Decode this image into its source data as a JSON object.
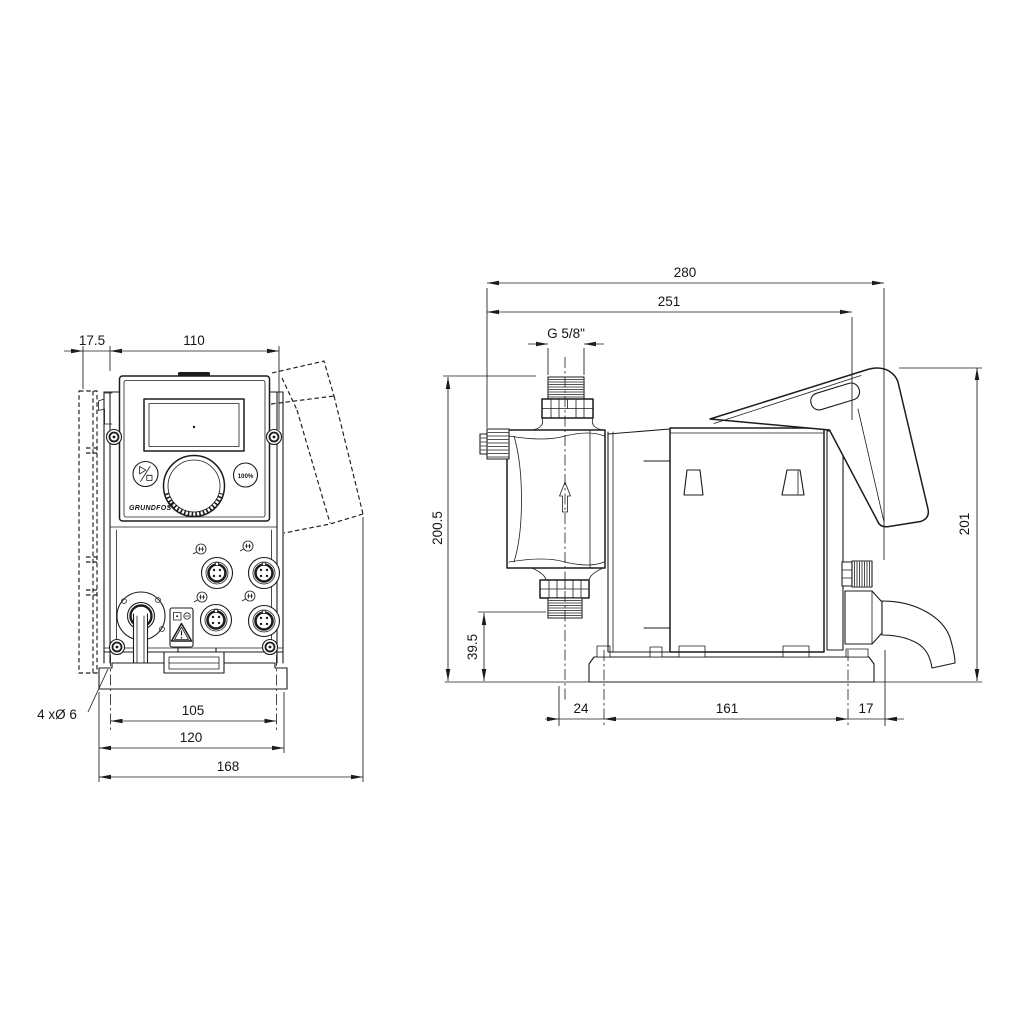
{
  "front_view": {
    "dim_offset": "17.5",
    "dim_width": "110",
    "dim_hole_spacing": "105",
    "dim_plate_width": "120",
    "dim_overall_width": "168",
    "holes_note": "4 xØ 6",
    "button_100": "100%",
    "brand": "GRUNDFOS"
  },
  "side_view": {
    "dim_overall_depth": "280",
    "dim_housing_depth": "251",
    "thread": "G 5/8\"",
    "dim_height": "200.5",
    "dim_inlet_height": "39.5",
    "dim_height_rear": "201",
    "dim_offset_front": "24",
    "dim_plate_length": "161",
    "dim_offset_rear": "17"
  },
  "colors": {
    "line": "#1c1c1c",
    "background": "#ffffff"
  }
}
